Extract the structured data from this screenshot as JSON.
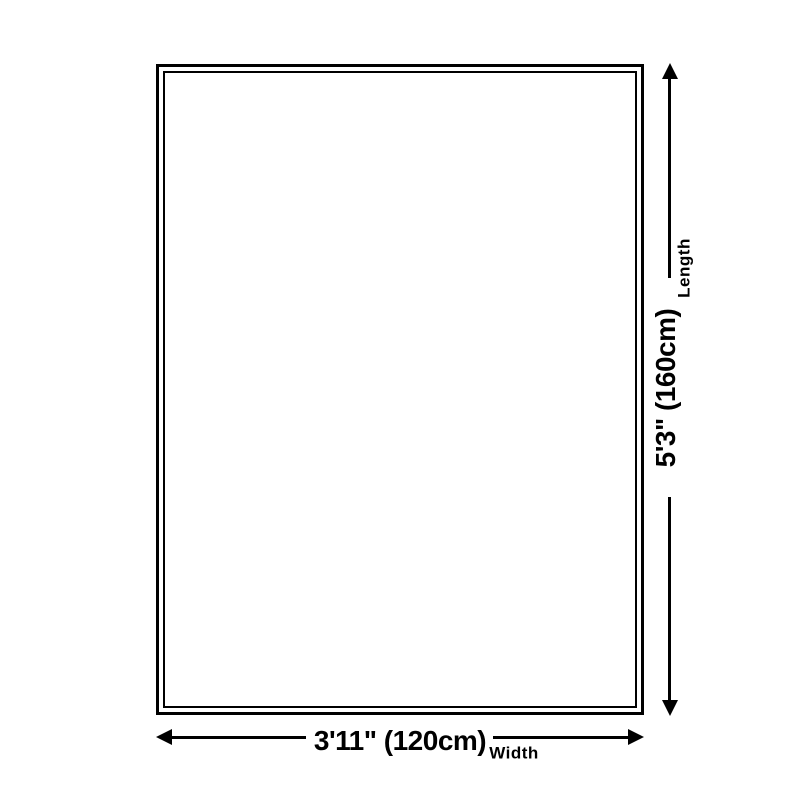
{
  "page": {
    "background_color": "#ffffff",
    "line_color": "#000000",
    "text_color": "#000000"
  },
  "diagram": {
    "type": "product-dimension-diagram",
    "subject": "rug-outline",
    "length": {
      "label": "Length",
      "value": "5'3\" (160cm)"
    },
    "width": {
      "label": "Width",
      "value": "3'11\" (120cm)"
    }
  }
}
